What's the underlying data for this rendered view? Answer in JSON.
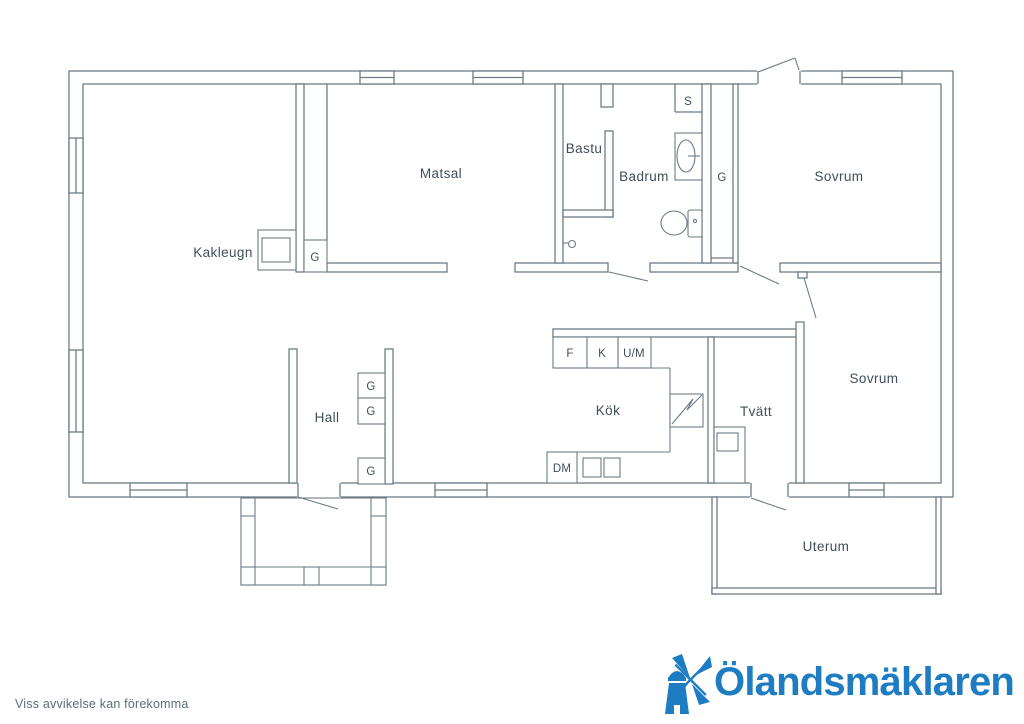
{
  "colors": {
    "wall": "#6d7c86",
    "room_label": "#3f4e59",
    "logo_blue": "#1d7cc2",
    "disclaimer": "#5b6e7b"
  },
  "plan": {
    "labels": {
      "matsal": "Matsal",
      "bastu": "Bastu",
      "badrum": "Badrum",
      "sovrum": "Sovrum",
      "kakleugn": "Kakleugn",
      "hall": "Hall",
      "kok": "Kök",
      "tvatt": "Tvätt",
      "uterum": "Uterum",
      "fridge": "F",
      "freezer": "K",
      "oven_micro": "U/M",
      "dishwasher": "DM",
      "sauna_heater": "S",
      "wardrobe": "G"
    }
  },
  "logo": {
    "name": "Ölandsmäklaren"
  },
  "footer": {
    "disclaimer": "Viss avvikelse kan förekomma"
  }
}
